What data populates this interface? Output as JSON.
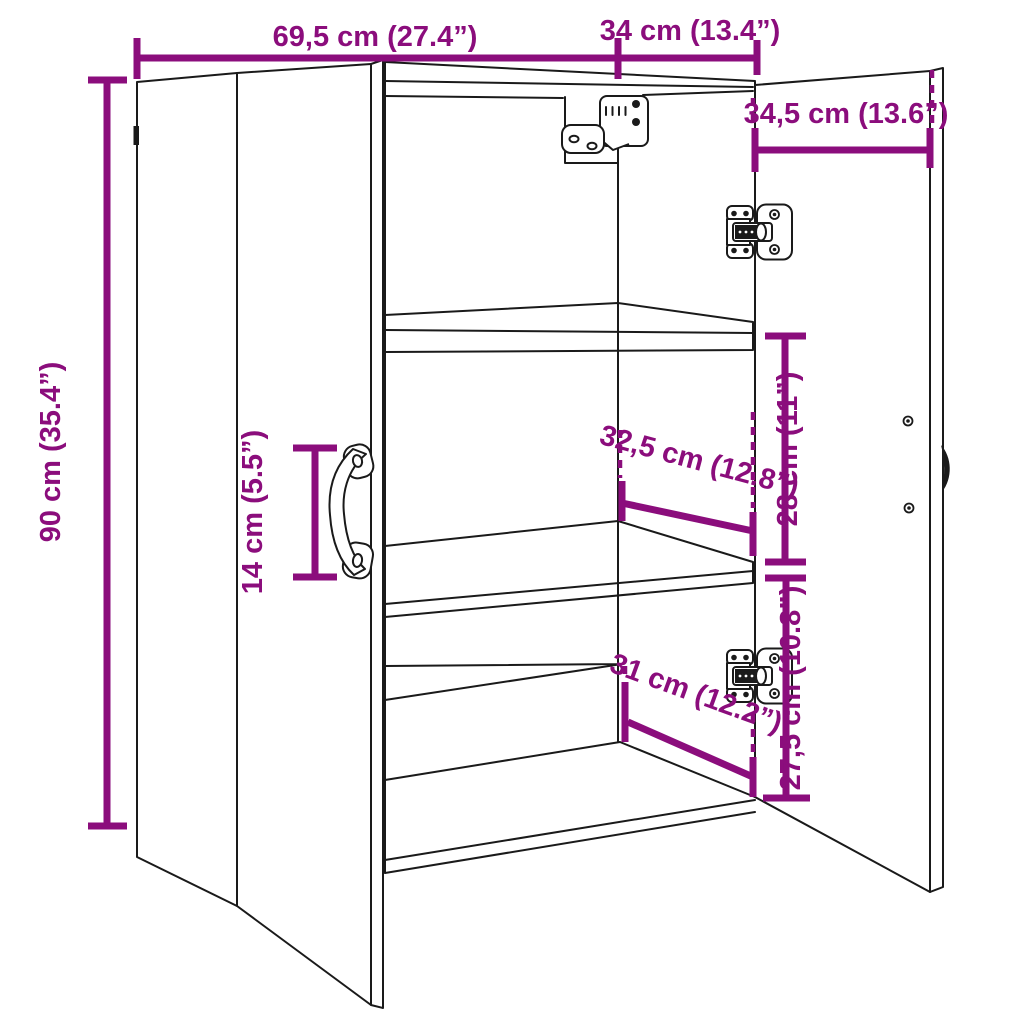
{
  "diagram": {
    "kind": "product-dimension-diagram",
    "subject": "wall cabinet with two doors and shelves",
    "colors": {
      "accent": "#8B0D7C",
      "line": "#1a1a1a",
      "background": "#ffffff"
    },
    "dimensions": {
      "total_width": "69,5 cm (27.4”)",
      "top_right_width": "34 cm (13.4”)",
      "door_width": "34,5 cm (13.6”)",
      "height": "90 cm (35.4”)",
      "handle_length": "14 cm (5.5”)",
      "interior_width": "32,5 cm (12.8”)",
      "shelf_gap_upper": "28 cm (11”)",
      "interior_width_lower": "31 cm (12.2”)",
      "shelf_gap_lower": "27,5 cm (10.8”)"
    }
  }
}
